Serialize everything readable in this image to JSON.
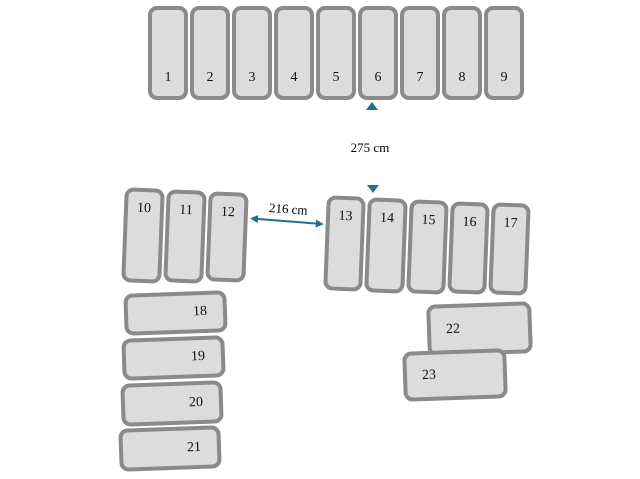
{
  "diagram": {
    "groups": [
      {
        "name": "top-row",
        "spots": [
          "1",
          "2",
          "3",
          "4",
          "5",
          "6",
          "7",
          "8",
          "9"
        ]
      },
      {
        "name": "middle-left",
        "spots": [
          "10",
          "11",
          "12"
        ]
      },
      {
        "name": "middle-right",
        "spots": [
          "13",
          "14",
          "15",
          "16",
          "17"
        ]
      },
      {
        "name": "bottom-left-stack",
        "spots": [
          "18",
          "19",
          "20",
          "21"
        ]
      },
      {
        "name": "bottom-right-pair",
        "spots": [
          "22",
          "23"
        ]
      }
    ],
    "measurements": {
      "vertical": "275 cm",
      "horizontal": "216 cm"
    },
    "colors": {
      "spot_fill": "#dcdcdc",
      "spot_border": "#8a8a8a",
      "arrow": "#21708c",
      "label_text": "#000000"
    }
  }
}
